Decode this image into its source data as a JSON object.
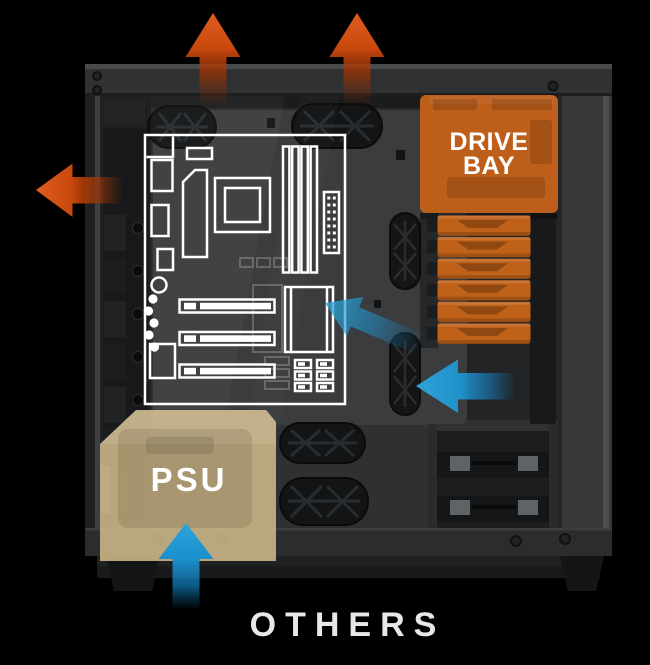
{
  "labels": {
    "drive_bay": {
      "line1": "DRIVE",
      "line2": "BAY"
    },
    "psu": "PSU",
    "others": "OTHERS"
  },
  "colors": {
    "background": "#000000",
    "case_body": "#2f3133",
    "case_interior": "#27292b",
    "motherboard_outline": "#ffffff",
    "exhaust_arrow_orange": "#d9561b",
    "intake_arrow_blue": "#219bd7",
    "drive_bay_overlay": "#bd5e1a",
    "psu_overlay": "#c9b384",
    "label_text": "#ffffff",
    "others_text": "#e7e8e9"
  },
  "icons": [
    {
      "name": "exhaust-arrow-top-left-icon",
      "shape": "arrow-up",
      "color": "#d9561b"
    },
    {
      "name": "exhaust-arrow-top-right-icon",
      "shape": "arrow-up",
      "color": "#d9561b"
    },
    {
      "name": "exhaust-arrow-rear-icon",
      "shape": "arrow-left",
      "color": "#d9561b"
    },
    {
      "name": "intake-arrow-chipset-icon",
      "shape": "arrow-up-left",
      "color": "#219bd7"
    },
    {
      "name": "intake-arrow-front-icon",
      "shape": "arrow-left",
      "color": "#219bd7"
    },
    {
      "name": "intake-arrow-psu-icon",
      "shape": "arrow-up",
      "color": "#219bd7"
    }
  ]
}
